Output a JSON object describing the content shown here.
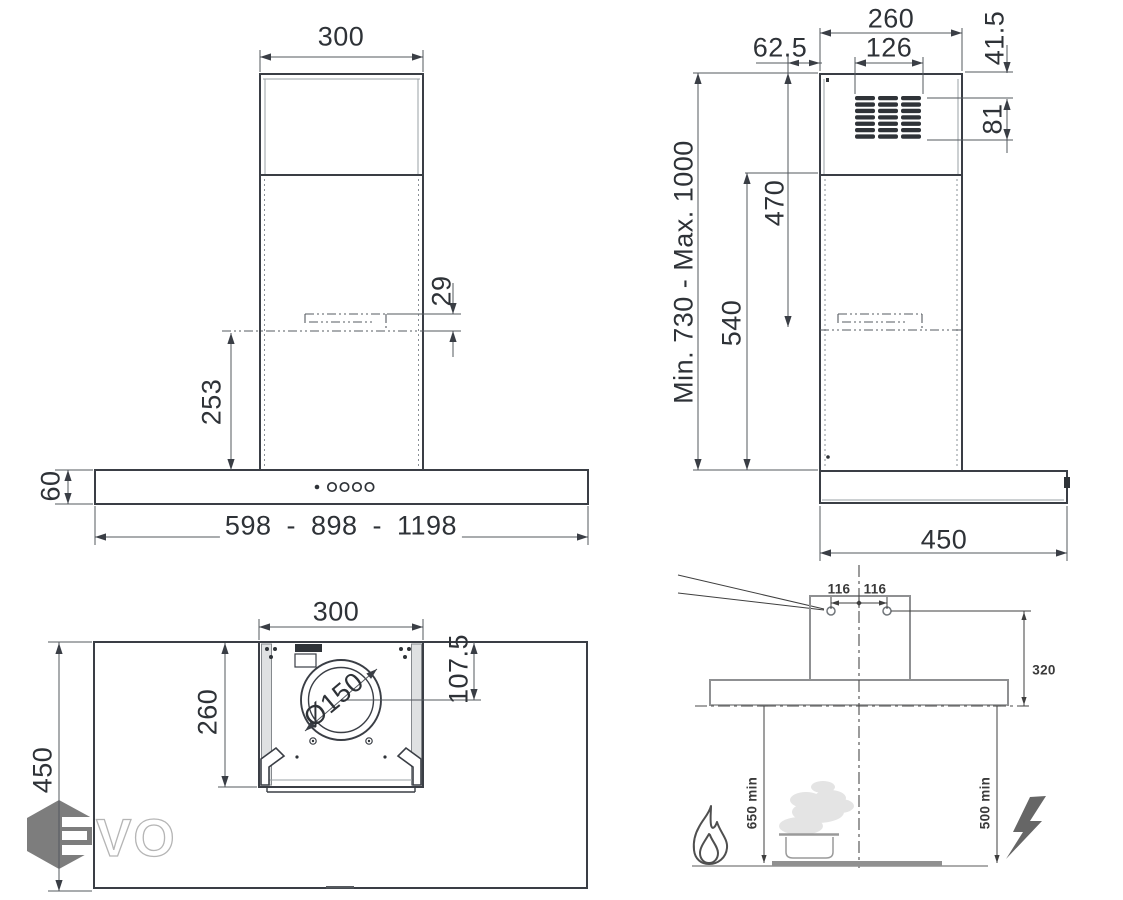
{
  "views": {
    "front": {
      "chimney_width": "300",
      "bracket_thickness": "29",
      "bracket_to_body": "253",
      "body_height": "60",
      "body_width_range": "598 - 898 - 1198"
    },
    "side": {
      "chimney_depth": "260",
      "bracket_offset": "62.5",
      "grille_width": "126",
      "grille_top_offset": "41.5",
      "grille_height": "81",
      "height_range": "Min. 730 - Max. 1000",
      "top_to_bracket": "470",
      "lower_chimney_height": "540",
      "body_depth": "450"
    },
    "top": {
      "motor_box_width": "300",
      "motor_box_depth": "260",
      "duct_diameter": "Ø150",
      "duct_offset": "107.5",
      "body_depth": "450"
    },
    "installation": {
      "hole_spacing_left": "116",
      "hole_spacing_right": "116",
      "bracket_drop": "320",
      "clearance_gas": "650 min",
      "clearance_electric": "500 min"
    }
  },
  "watermark": {
    "logo_text": "VO"
  },
  "colors": {
    "outline": "#3a3e45",
    "dimension": "#53585e",
    "installation_gray": "#8f9092",
    "watermark_gray": "#7d7d7d",
    "steam": "#e4e4e4"
  }
}
